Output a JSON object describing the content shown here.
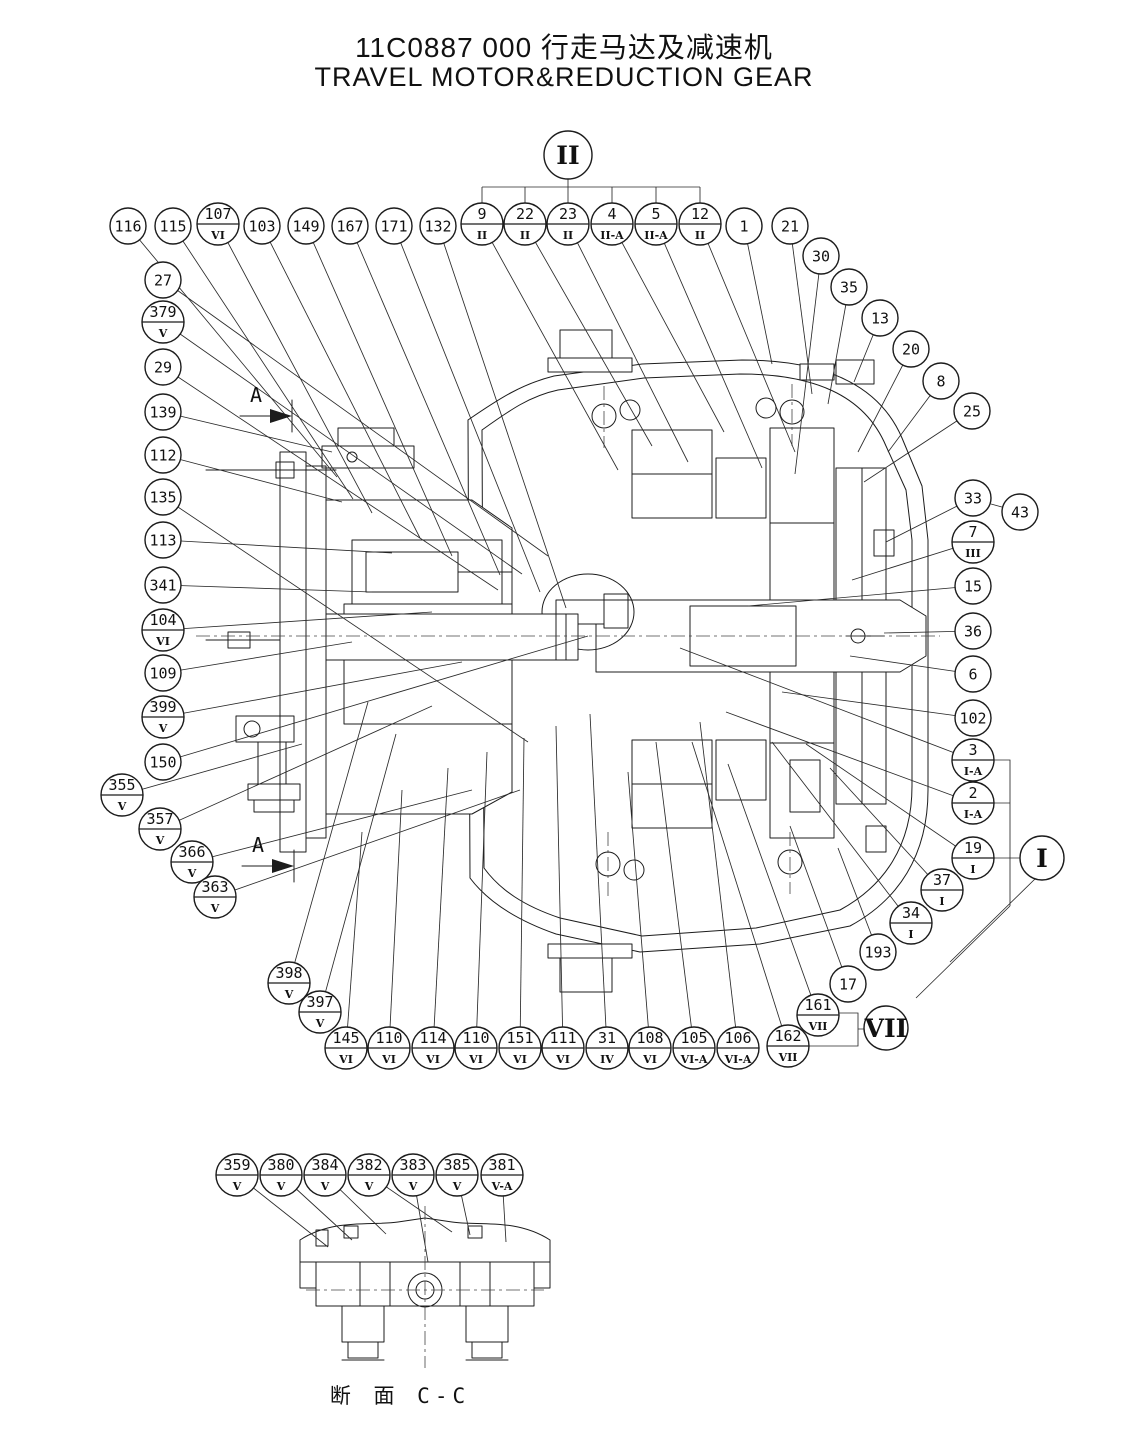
{
  "title": {
    "cn": "11C0887 000  行走马达及减速机",
    "en": "TRAVEL MOTOR&REDUCTION GEAR"
  },
  "section_caption": "断 面  C-C",
  "section_label": "A",
  "details": [
    {
      "label": "II",
      "x": 568,
      "y": 155,
      "r": 24
    },
    {
      "label": "I",
      "x": 1042,
      "y": 858,
      "r": 22
    },
    {
      "label": "VII",
      "x": 886,
      "y": 1028,
      "r": 22
    }
  ],
  "bracket": {
    "top_x": 568,
    "top_y": 179,
    "y": 187,
    "drop_to": 203,
    "children": [
      482,
      525,
      568,
      612,
      656,
      700
    ]
  },
  "arrows": [
    {
      "x": 256,
      "y": 402
    },
    {
      "x": 258,
      "y": 852
    }
  ],
  "balloons": [
    {
      "n": "116",
      "s": null,
      "x": 128,
      "y": 226,
      "tx": 337,
      "ty": 477
    },
    {
      "n": "115",
      "s": null,
      "x": 173,
      "y": 226,
      "tx": 353,
      "ty": 499
    },
    {
      "n": "107",
      "s": "VI",
      "x": 218,
      "y": 224,
      "tx": 372,
      "ty": 513
    },
    {
      "n": "103",
      "s": null,
      "x": 262,
      "y": 226,
      "tx": 420,
      "ty": 538
    },
    {
      "n": "149",
      "s": null,
      "x": 306,
      "y": 226,
      "tx": 452,
      "ty": 556
    },
    {
      "n": "167",
      "s": null,
      "x": 350,
      "y": 226,
      "tx": 500,
      "ty": 575
    },
    {
      "n": "171",
      "s": null,
      "x": 394,
      "y": 226,
      "tx": 540,
      "ty": 592
    },
    {
      "n": "132",
      "s": null,
      "x": 438,
      "y": 226,
      "tx": 566,
      "ty": 608
    },
    {
      "n": "9",
      "s": "II",
      "x": 482,
      "y": 224,
      "tx": 618,
      "ty": 470
    },
    {
      "n": "22",
      "s": "II",
      "x": 525,
      "y": 224,
      "tx": 652,
      "ty": 446
    },
    {
      "n": "23",
      "s": "II",
      "x": 568,
      "y": 224,
      "tx": 688,
      "ty": 462
    },
    {
      "n": "4",
      "s": "II-A",
      "x": 612,
      "y": 224,
      "tx": 724,
      "ty": 432
    },
    {
      "n": "5",
      "s": "II-A",
      "x": 656,
      "y": 224,
      "tx": 762,
      "ty": 468
    },
    {
      "n": "12",
      "s": "II",
      "x": 700,
      "y": 224,
      "tx": 795,
      "ty": 452
    },
    {
      "n": "1",
      "s": null,
      "x": 744,
      "y": 226,
      "tx": 772,
      "ty": 364
    },
    {
      "n": "21",
      "s": null,
      "x": 790,
      "y": 226,
      "tx": 812,
      "ty": 394
    },
    {
      "n": "30",
      "s": null,
      "x": 821,
      "y": 256,
      "tx": 795,
      "ty": 474
    },
    {
      "n": "35",
      "s": null,
      "x": 849,
      "y": 287,
      "tx": 828,
      "ty": 404
    },
    {
      "n": "13",
      "s": null,
      "x": 880,
      "y": 318,
      "tx": 854,
      "ty": 382
    },
    {
      "n": "20",
      "s": null,
      "x": 911,
      "y": 349,
      "tx": 858,
      "ty": 452
    },
    {
      "n": "8",
      "s": null,
      "x": 941,
      "y": 381,
      "tx": 888,
      "ty": 452
    },
    {
      "n": "25",
      "s": null,
      "x": 972,
      "y": 411,
      "tx": 864,
      "ty": 482
    },
    {
      "n": "33",
      "s": null,
      "x": 973,
      "y": 498,
      "tx": 886,
      "ty": 542
    },
    {
      "n": "43",
      "s": null,
      "x": 1020,
      "y": 512,
      "tx": 991,
      "ty": 504
    },
    {
      "n": "7",
      "s": "III",
      "x": 973,
      "y": 542,
      "tx": 852,
      "ty": 580
    },
    {
      "n": "15",
      "s": null,
      "x": 973,
      "y": 586,
      "tx": 748,
      "ty": 606
    },
    {
      "n": "36",
      "s": null,
      "x": 973,
      "y": 631,
      "tx": 884,
      "ty": 633
    },
    {
      "n": "6",
      "s": null,
      "x": 973,
      "y": 674,
      "tx": 850,
      "ty": 656
    },
    {
      "n": "102",
      "s": null,
      "x": 973,
      "y": 718,
      "tx": 782,
      "ty": 692
    },
    {
      "n": "3",
      "s": "I-A",
      "x": 973,
      "y": 760,
      "tx": 680,
      "ty": 648
    },
    {
      "n": "2",
      "s": "I-A",
      "x": 973,
      "y": 803,
      "tx": 726,
      "ty": 712
    },
    {
      "n": "19",
      "s": "I",
      "x": 973,
      "y": 858,
      "tx": 806,
      "ty": 744
    },
    {
      "n": "37",
      "s": "I",
      "x": 942,
      "y": 890,
      "tx": 830,
      "ty": 768
    },
    {
      "n": "34",
      "s": "I",
      "x": 911,
      "y": 923,
      "tx": 772,
      "ty": 742
    },
    {
      "n": "193",
      "s": null,
      "x": 878,
      "y": 952,
      "tx": 838,
      "ty": 848
    },
    {
      "n": "17",
      "s": null,
      "x": 848,
      "y": 984,
      "tx": 790,
      "ty": 826
    },
    {
      "n": "161",
      "s": "VII",
      "x": 818,
      "y": 1015,
      "tx": 728,
      "ty": 764
    },
    {
      "n": "162",
      "s": "VII",
      "x": 788,
      "y": 1046,
      "tx": 692,
      "ty": 742
    },
    {
      "n": "27",
      "s": null,
      "x": 163,
      "y": 280,
      "tx": 548,
      "ty": 556
    },
    {
      "n": "379",
      "s": "V",
      "x": 163,
      "y": 322,
      "tx": 522,
      "ty": 574
    },
    {
      "n": "29",
      "s": null,
      "x": 163,
      "y": 367,
      "tx": 498,
      "ty": 590
    },
    {
      "n": "139",
      "s": null,
      "x": 163,
      "y": 412,
      "tx": 332,
      "ty": 452
    },
    {
      "n": "112",
      "s": null,
      "x": 163,
      "y": 455,
      "tx": 342,
      "ty": 502
    },
    {
      "n": "135",
      "s": null,
      "x": 163,
      "y": 497,
      "tx": 528,
      "ty": 742
    },
    {
      "n": "113",
      "s": null,
      "x": 163,
      "y": 540,
      "tx": 392,
      "ty": 553
    },
    {
      "n": "341",
      "s": null,
      "x": 163,
      "y": 585,
      "tx": 372,
      "ty": 592
    },
    {
      "n": "104",
      "s": "VI",
      "x": 163,
      "y": 630,
      "tx": 432,
      "ty": 612
    },
    {
      "n": "109",
      "s": null,
      "x": 163,
      "y": 673,
      "tx": 352,
      "ty": 642
    },
    {
      "n": "399",
      "s": "V",
      "x": 163,
      "y": 717,
      "tx": 462,
      "ty": 662
    },
    {
      "n": "150",
      "s": null,
      "x": 163,
      "y": 762,
      "tx": 588,
      "ty": 636
    },
    {
      "n": "355",
      "s": "V",
      "x": 122,
      "y": 795,
      "tx": 302,
      "ty": 744
    },
    {
      "n": "357",
      "s": "V",
      "x": 160,
      "y": 829,
      "tx": 432,
      "ty": 706
    },
    {
      "n": "366",
      "s": "V",
      "x": 192,
      "y": 862,
      "tx": 472,
      "ty": 790
    },
    {
      "n": "363",
      "s": "V",
      "x": 215,
      "y": 897,
      "tx": 520,
      "ty": 790
    },
    {
      "n": "398",
      "s": "V",
      "x": 289,
      "y": 983,
      "tx": 368,
      "ty": 702
    },
    {
      "n": "397",
      "s": "V",
      "x": 320,
      "y": 1012,
      "tx": 396,
      "ty": 734
    },
    {
      "n": "145",
      "s": "VI",
      "x": 346,
      "y": 1048,
      "tx": 362,
      "ty": 832
    },
    {
      "n": "110",
      "s": "VI",
      "x": 389,
      "y": 1048,
      "tx": 402,
      "ty": 790
    },
    {
      "n": "114",
      "s": "VI",
      "x": 433,
      "y": 1048,
      "tx": 448,
      "ty": 768
    },
    {
      "n": "110",
      "s": "VI",
      "x": 476,
      "y": 1048,
      "tx": 487,
      "ty": 752
    },
    {
      "n": "151",
      "s": "VI",
      "x": 520,
      "y": 1048,
      "tx": 524,
      "ty": 738
    },
    {
      "n": "111",
      "s": "VI",
      "x": 563,
      "y": 1048,
      "tx": 556,
      "ty": 726
    },
    {
      "n": "31",
      "s": "IV",
      "x": 607,
      "y": 1048,
      "tx": 590,
      "ty": 714
    },
    {
      "n": "108",
      "s": "VI",
      "x": 650,
      "y": 1048,
      "tx": 628,
      "ty": 772
    },
    {
      "n": "105",
      "s": "VI-A",
      "x": 694,
      "y": 1048,
      "tx": 656,
      "ty": 742
    },
    {
      "n": "106",
      "s": "VI-A",
      "x": 738,
      "y": 1048,
      "tx": 700,
      "ty": 722
    },
    {
      "n": "359",
      "s": "V",
      "x": 237,
      "y": 1175,
      "tx": 328,
      "ty": 1247
    },
    {
      "n": "380",
      "s": "V",
      "x": 281,
      "y": 1175,
      "tx": 352,
      "ty": 1240
    },
    {
      "n": "384",
      "s": "V",
      "x": 325,
      "y": 1175,
      "tx": 386,
      "ty": 1234
    },
    {
      "n": "382",
      "s": "V",
      "x": 369,
      "y": 1175,
      "tx": 452,
      "ty": 1232
    },
    {
      "n": "383",
      "s": "V",
      "x": 413,
      "y": 1175,
      "tx": 428,
      "ty": 1262
    },
    {
      "n": "385",
      "s": "V",
      "x": 457,
      "y": 1175,
      "tx": 470,
      "ty": 1235
    },
    {
      "n": "381",
      "s": "V-A",
      "x": 502,
      "y": 1175,
      "tx": 506,
      "ty": 1242
    }
  ]
}
